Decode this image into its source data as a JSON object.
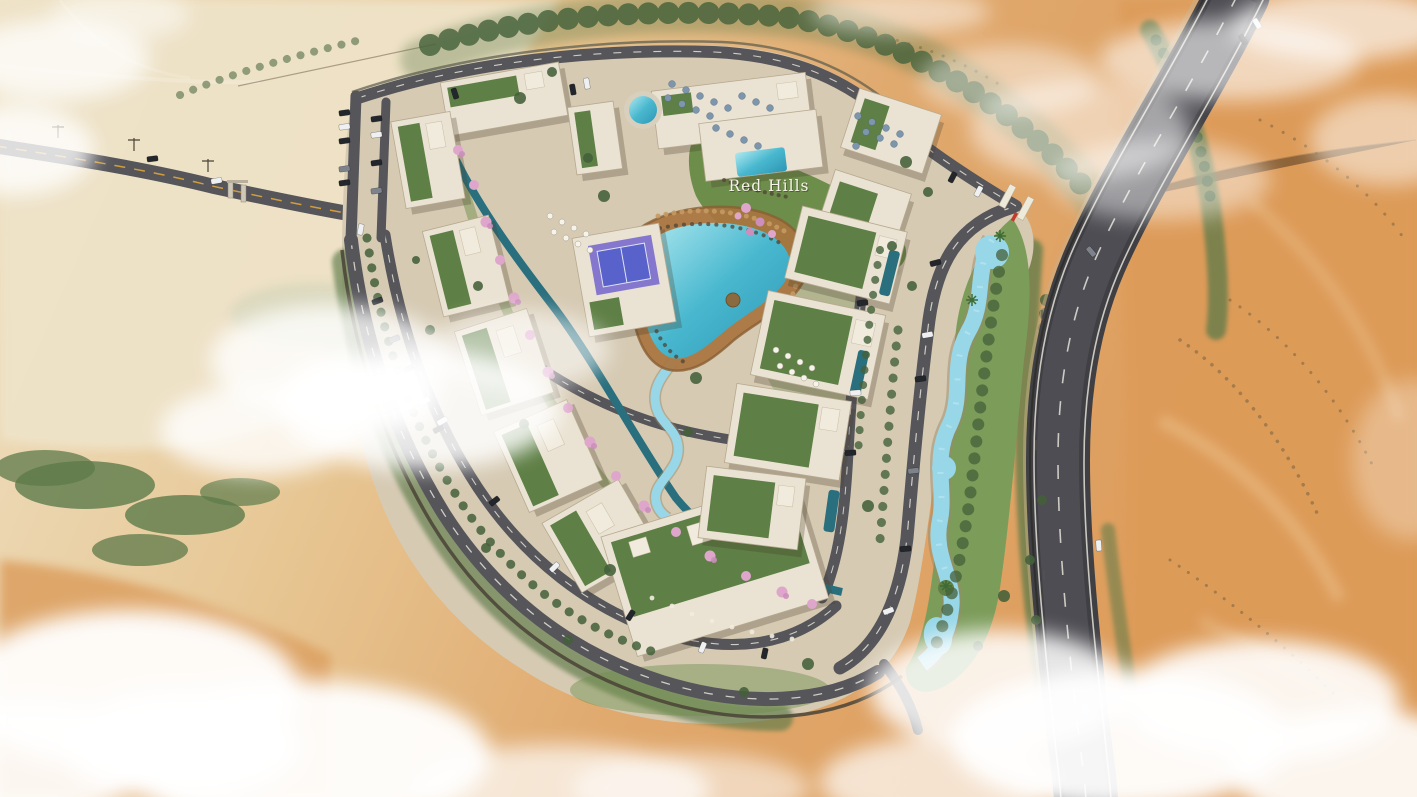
{
  "logo": {
    "text": "Red Hills"
  },
  "palette": {
    "sand": "#e2ab6e",
    "sand_pale": "#efe3c8",
    "sand_deep": "#dd9b59",
    "sand_orange": "#dda263",
    "ground": "#d6cab3",
    "wall": "#4a4336",
    "asphalt": "#55555a",
    "asphalt_dark": "#3f3f44",
    "road_marking": "#edebe0",
    "road_yellow": "#d9a13b",
    "grass": "#6f8f4c",
    "grass_dark": "#44603a",
    "scrub": "#5d7a4a",
    "building": "#eae2d2",
    "building_shade": "#b6a98f",
    "roof_green": "#5e7f45",
    "roof_white": "#f1ebdd",
    "pool_light": "#9fe0ea",
    "pool": "#49b8cf",
    "pool_deep": "#2f96b4",
    "lap_pool": "#2a6f7e",
    "lazy_river": "#97d7e8",
    "deck": "#a9743f",
    "deck_dark": "#8a5f33",
    "padel_purple": "#8071cc",
    "padel_blue": "#5561c9",
    "flower_pink": "#dfa6cc",
    "flower_pink_dark": "#cc8ebd",
    "cloud": "#ffffff",
    "logo": "#f6f3ea",
    "gate_red": "#c23b2e",
    "car_dark": "#23262b",
    "car_white": "#eef0f2",
    "car_gray": "#7e838b",
    "car_blue": "#3a6ab0"
  }
}
